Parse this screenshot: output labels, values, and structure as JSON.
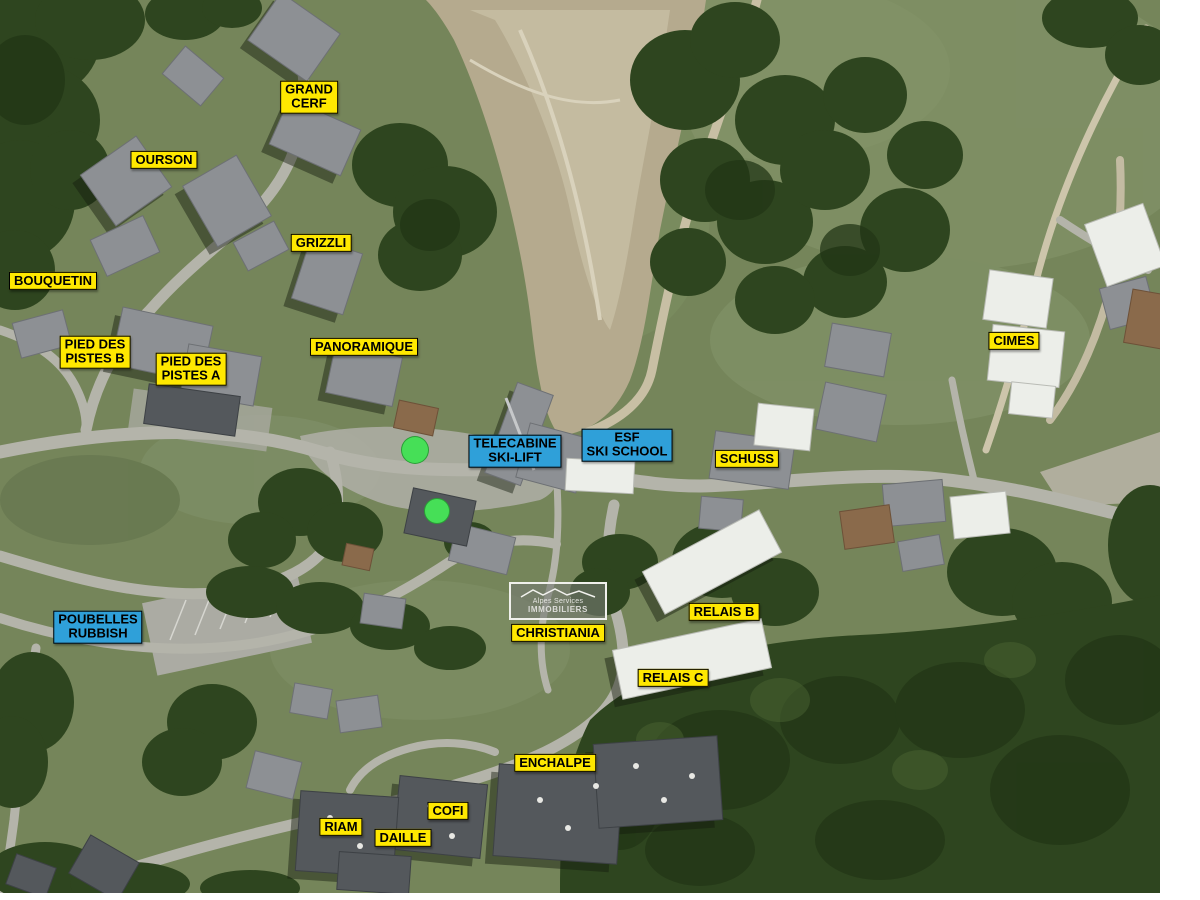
{
  "map": {
    "colors": {
      "label_yellow": "#FFE800",
      "label_blue": "#2FA0D9",
      "label_text": "#000000",
      "marker_green": "#46DF57"
    },
    "labels": [
      {
        "id": "grand-cerf",
        "type": "yellow",
        "lines": [
          "GRAND",
          "CERF"
        ],
        "x": 309,
        "y": 97
      },
      {
        "id": "ourson",
        "type": "yellow",
        "lines": [
          "OURSON"
        ],
        "x": 164,
        "y": 160
      },
      {
        "id": "grizzli",
        "type": "yellow",
        "lines": [
          "GRIZZLI"
        ],
        "x": 321,
        "y": 243
      },
      {
        "id": "bouquetin",
        "type": "yellow",
        "lines": [
          "BOUQUETIN"
        ],
        "x": 53,
        "y": 281
      },
      {
        "id": "pied-des-pistes-b",
        "type": "yellow",
        "lines": [
          "PIED DES",
          "PISTES B"
        ],
        "x": 95,
        "y": 352
      },
      {
        "id": "pied-des-pistes-a",
        "type": "yellow",
        "lines": [
          "PIED DES",
          "PISTES A"
        ],
        "x": 191,
        "y": 369
      },
      {
        "id": "panoramique",
        "type": "yellow",
        "lines": [
          "PANORAMIQUE"
        ],
        "x": 364,
        "y": 347
      },
      {
        "id": "telecabine-ski-lift",
        "type": "blue",
        "lines": [
          "TELECABINE",
          "SKI-LIFT"
        ],
        "x": 515,
        "y": 451
      },
      {
        "id": "esf-ski-school",
        "type": "blue",
        "lines": [
          "ESF",
          "SKI SCHOOL"
        ],
        "x": 627,
        "y": 445
      },
      {
        "id": "schuss",
        "type": "yellow",
        "lines": [
          "SCHUSS"
        ],
        "x": 747,
        "y": 459
      },
      {
        "id": "cimes",
        "type": "yellow",
        "lines": [
          "CIMES"
        ],
        "x": 1014,
        "y": 341
      },
      {
        "id": "poubelles-rubbish",
        "type": "blue",
        "lines": [
          "POUBELLES",
          "RUBBISH"
        ],
        "x": 98,
        "y": 627
      },
      {
        "id": "christiania",
        "type": "yellow",
        "lines": [
          "CHRISTIANIA"
        ],
        "x": 558,
        "y": 633
      },
      {
        "id": "relais-b",
        "type": "yellow",
        "lines": [
          "RELAIS B"
        ],
        "x": 724,
        "y": 612
      },
      {
        "id": "relais-c",
        "type": "yellow",
        "lines": [
          "RELAIS C"
        ],
        "x": 673,
        "y": 678
      },
      {
        "id": "enchalpe",
        "type": "yellow",
        "lines": [
          "ENCHALPE"
        ],
        "x": 555,
        "y": 763
      },
      {
        "id": "cofi",
        "type": "yellow",
        "lines": [
          "COFI"
        ],
        "x": 448,
        "y": 811
      },
      {
        "id": "riam",
        "type": "yellow",
        "lines": [
          "RIAM"
        ],
        "x": 341,
        "y": 827
      },
      {
        "id": "daille",
        "type": "yellow",
        "lines": [
          "DAILLE"
        ],
        "x": 403,
        "y": 838
      }
    ],
    "logo": {
      "line1": "Alpes Services",
      "line2": "IMMOBILIERS"
    },
    "markers": [
      {
        "id": "green-dot-upper",
        "x": 415,
        "y": 450,
        "r": 13
      },
      {
        "id": "green-dot-lower",
        "x": 437,
        "y": 511,
        "r": 12
      }
    ]
  }
}
